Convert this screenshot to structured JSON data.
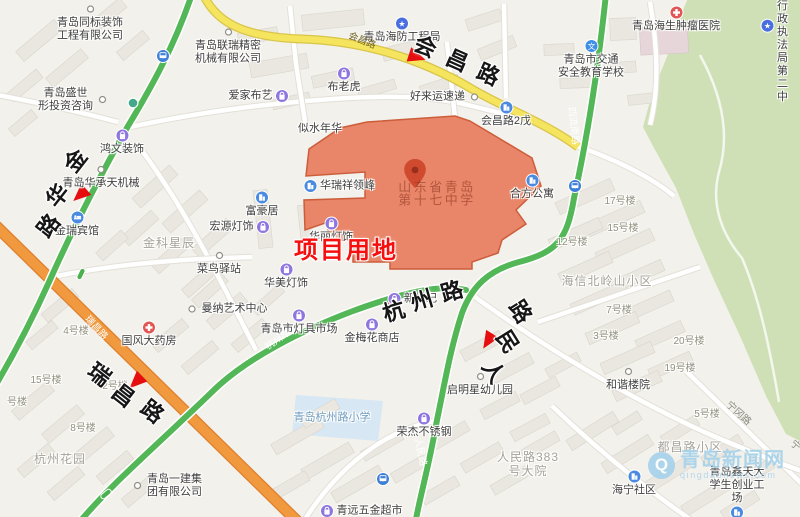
{
  "map": {
    "project_area_label": {
      "text": "项目用地",
      "x": 346,
      "y": 251,
      "color": "#f50f0f"
    },
    "project_site": {
      "name": "山东省青岛第十七中学",
      "line1": "山东省青岛",
      "line2": "第十七中学",
      "x": 437,
      "y": 187,
      "fill": "#e87c5c",
      "border": "#cc5d3a",
      "pin_icon": "map-pin-icon"
    },
    "watermark": {
      "title": "青岛新闻网",
      "subtitle": "qingdaonews.com",
      "logo_letter": "Q"
    },
    "roads_big": [
      {
        "name": "会昌路",
        "rot": 24,
        "chars": [
          {
            "c": "会",
            "x": 425,
            "y": 47
          },
          {
            "c": "昌",
            "x": 457,
            "y": 61
          },
          {
            "c": "路",
            "x": 488,
            "y": 75
          }
        ]
      },
      {
        "name": "金华路",
        "rot": -52,
        "chars": [
          {
            "c": "金",
            "x": 76,
            "y": 161
          },
          {
            "c": "华",
            "x": 58,
            "y": 196
          },
          {
            "c": "路",
            "x": 49,
            "y": 226
          }
        ]
      },
      {
        "name": "杭州路",
        "rot": -16,
        "chars": [
          {
            "c": "杭",
            "x": 394,
            "y": 312
          },
          {
            "c": "州",
            "x": 422,
            "y": 301
          },
          {
            "c": "路",
            "x": 452,
            "y": 292
          }
        ]
      },
      {
        "name": "人民路",
        "rot": 58,
        "chars": [
          {
            "c": "路",
            "x": 520,
            "y": 312
          },
          {
            "c": "民",
            "x": 507,
            "y": 342
          },
          {
            "c": "人",
            "x": 493,
            "y": 372
          }
        ]
      },
      {
        "name": "瑞昌路",
        "rot": 38,
        "chars": [
          {
            "c": "瑞",
            "x": 99,
            "y": 375
          },
          {
            "c": "昌",
            "x": 123,
            "y": 396
          },
          {
            "c": "路",
            "x": 152,
            "y": 412
          }
        ]
      }
    ],
    "road_labels_small": [
      {
        "text": "会昌路",
        "x": 362,
        "y": 41,
        "rot": 22,
        "style": "on-yellow"
      },
      {
        "text": "四流南路",
        "x": 573,
        "y": 126,
        "rot": 84,
        "style": "on-green"
      },
      {
        "text": "人民路",
        "x": 420,
        "y": 452,
        "rot": 78,
        "style": "on-green"
      },
      {
        "text": "杭州路",
        "x": 278,
        "y": 340,
        "rot": -35,
        "style": "on-green"
      },
      {
        "text": "瑞昌路",
        "x": 96,
        "y": 328,
        "rot": 48,
        "style": "on-orange"
      },
      {
        "text": "宁冈路",
        "x": 738,
        "y": 414,
        "rot": 42,
        "style": "on-street"
      },
      {
        "text": "宁",
        "x": 795,
        "y": 446,
        "rot": 42,
        "style": "on-street"
      }
    ],
    "pois": [
      {
        "t": "青岛同标装饰\n工程有限公司",
        "x": 90,
        "y": 22,
        "icon": "dot",
        "ip": "top"
      },
      {
        "t": "青岛联瑞精密\n机械有限公司",
        "x": 228,
        "y": 45,
        "icon": "dot",
        "ip": "top"
      },
      {
        "t": "青岛盛世\n形投资咨询",
        "x": 74,
        "y": 100,
        "icon": "dot",
        "ip": "right"
      },
      {
        "t": "爱家布艺",
        "x": 259,
        "y": 96,
        "icon": "shop",
        "ip": "right"
      },
      {
        "t": "布老虎",
        "x": 344,
        "y": 80,
        "icon": "shop",
        "ip": "top"
      },
      {
        "t": "青岛海防工程局",
        "x": 402,
        "y": 30,
        "icon": "star",
        "ip": "top"
      },
      {
        "t": "好来运速递",
        "x": 446,
        "y": 97,
        "icon": "dot",
        "ip": "right"
      },
      {
        "t": "会昌路2戊",
        "x": 506,
        "y": 114,
        "icon": "bldg",
        "ip": "top"
      },
      {
        "t": "青岛海生肿瘤医院",
        "x": 676,
        "y": 19,
        "icon": "hosp",
        "ip": "top"
      },
      {
        "t": "青岛市交通\n安全教育学校",
        "x": 591,
        "y": 59,
        "icon": "school",
        "ip": "top"
      },
      {
        "t": "四方城管行政\n执法局第二中",
        "x": 774,
        "y": 26,
        "icon": "star",
        "ip": "left"
      },
      {
        "t": "鸿文装饰",
        "x": 122,
        "y": 142,
        "icon": "shop",
        "ip": "top"
      },
      {
        "t": "青岛华承天机械",
        "x": 101,
        "y": 176,
        "icon": "dot",
        "ip": "top"
      },
      {
        "t": "金瑞宾馆",
        "x": 77,
        "y": 224,
        "icon": "hotel",
        "ip": "top"
      },
      {
        "t": "似水年华",
        "x": 320,
        "y": 129,
        "icon": null,
        "ip": "top"
      },
      {
        "t": "华瑞祥领峰",
        "x": 339,
        "y": 186,
        "icon": "bldg",
        "ip": "left"
      },
      {
        "t": "合方公寓",
        "x": 532,
        "y": 187,
        "icon": "bldg",
        "ip": "top"
      },
      {
        "t": "富豪居",
        "x": 262,
        "y": 204,
        "icon": "bldg",
        "ip": "top"
      },
      {
        "t": "宏源灯饰",
        "x": 240,
        "y": 227,
        "icon": "shop",
        "ip": "right"
      },
      {
        "t": "华丽灯饰",
        "x": 331,
        "y": 230,
        "icon": "shop",
        "ip": "top"
      },
      {
        "t": "菜鸟驿站",
        "x": 219,
        "y": 262,
        "icon": "dot",
        "ip": "top"
      },
      {
        "t": "华美灯饰",
        "x": 286,
        "y": 276,
        "icon": "shop",
        "ip": "top"
      },
      {
        "t": "曼纳艺术中心",
        "x": 226,
        "y": 309,
        "icon": "dot",
        "ip": "left"
      },
      {
        "t": "国风大药房",
        "x": 149,
        "y": 334,
        "icon": "pharm",
        "ip": "top"
      },
      {
        "t": "青岛市灯具市场",
        "x": 299,
        "y": 322,
        "icon": "shop",
        "ip": "top"
      },
      {
        "t": "金梅花商店",
        "x": 372,
        "y": 331,
        "icon": "shop",
        "ip": "top"
      },
      {
        "t": "新世纪",
        "x": 412,
        "y": 299,
        "icon": "shop",
        "ip": "left"
      },
      {
        "t": "启明星幼儿园",
        "x": 480,
        "y": 383,
        "icon": "dot",
        "ip": "top"
      },
      {
        "t": "和谐楼院",
        "x": 628,
        "y": 378,
        "icon": "dot",
        "ip": "top"
      },
      {
        "t": "青岛一建集\n团有限公司",
        "x": 166,
        "y": 486,
        "icon": "dot",
        "ip": "left"
      },
      {
        "t": "青远五金超市",
        "x": 361,
        "y": 511,
        "icon": "shop",
        "ip": "left"
      },
      {
        "t": "荣杰不锈钢",
        "x": 424,
        "y": 425,
        "icon": "shop",
        "ip": "top"
      },
      {
        "t": "海宁社区",
        "x": 634,
        "y": 483,
        "icon": "bldg",
        "ip": "top"
      },
      {
        "t": "青岛鑫天大\n学生创业工场",
        "x": 737,
        "y": 493,
        "icon": "bldg",
        "ip": "bottom"
      }
    ],
    "area_labels": [
      {
        "t": "金科星辰",
        "x": 169,
        "y": 243
      },
      {
        "t": "海信北岭山小区",
        "x": 607,
        "y": 281
      },
      {
        "t": "杭州花园",
        "x": 60,
        "y": 459
      },
      {
        "t": "都昌路小区",
        "x": 690,
        "y": 447
      },
      {
        "t": "人民路383\n号大院",
        "x": 528,
        "y": 464
      }
    ],
    "school_area_label": {
      "t": "青岛杭州路小学",
      "x": 332,
      "y": 418
    },
    "building_labels": [
      {
        "t": "17号楼",
        "x": 620,
        "y": 202
      },
      {
        "t": "15号楼",
        "x": 623,
        "y": 229
      },
      {
        "t": "12号楼",
        "x": 572,
        "y": 243
      },
      {
        "t": "7号楼",
        "x": 619,
        "y": 311
      },
      {
        "t": "3号楼",
        "x": 606,
        "y": 337
      },
      {
        "t": "20号楼",
        "x": 689,
        "y": 342
      },
      {
        "t": "19号楼",
        "x": 680,
        "y": 369
      },
      {
        "t": "4号楼",
        "x": 76,
        "y": 332
      },
      {
        "t": "15号楼",
        "x": 46,
        "y": 381
      },
      {
        "t": "2号楼",
        "x": 115,
        "y": 387
      },
      {
        "t": "8号楼",
        "x": 83,
        "y": 429
      },
      {
        "t": "号楼",
        "x": 17,
        "y": 403
      },
      {
        "t": "5号楼",
        "x": 707,
        "y": 415
      }
    ],
    "direction_arrows": [
      {
        "x": 417,
        "y": 57,
        "rot": 108
      },
      {
        "x": 80,
        "y": 195,
        "rot": 228
      },
      {
        "x": 392,
        "y": 302,
        "rot": -8
      },
      {
        "x": 488,
        "y": 341,
        "rot": 212
      },
      {
        "x": 136,
        "y": 382,
        "rot": 226
      }
    ],
    "transit_stops": [
      {
        "x": 163,
        "y": 56,
        "kind": "bus"
      },
      {
        "x": 133,
        "y": 103,
        "kind": "stop-dot"
      },
      {
        "x": 575,
        "y": 186,
        "kind": "bus"
      },
      {
        "x": 383,
        "y": 479,
        "kind": "bus"
      },
      {
        "x": 106,
        "y": 494,
        "kind": "stop-pill",
        "rot": -40
      },
      {
        "x": 81,
        "y": 274,
        "kind": "stop-pill",
        "rot": -64
      }
    ],
    "colors": {
      "green_route": "#54b757",
      "orange_road": "#f0993f",
      "yellow_road": "#f4e45e",
      "park": "#cfe0b6",
      "school_area": "#d7e7f4",
      "arrow_red": "#e50d0d",
      "project_fill": "#e87c5c",
      "project_border": "#cc5d3a",
      "project_text": "#f50f0f",
      "watermark": "#a6d2ea"
    }
  }
}
